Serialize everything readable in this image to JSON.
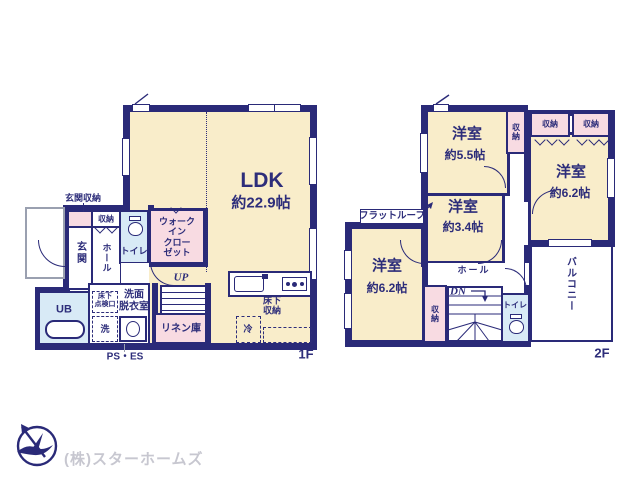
{
  "colors": {
    "wall": "#2a2a78",
    "ink": "#2d2d7a",
    "cream": "#f9edca",
    "pink": "#f8dbe2",
    "blue": "#d8eaf6",
    "logo_text": "#c7c7d0",
    "porch": "#9aa0b0"
  },
  "floor1": {
    "label": "1F",
    "ldk": {
      "name": "LDK",
      "size": "約22.9帖"
    },
    "entrance_storage": "玄関収納",
    "closet": "収納",
    "entrance": "玄関",
    "hall": "ホール",
    "toilet": "トイレ",
    "walk_in_closet": [
      "ウォーク",
      "イン",
      "クロー",
      "ゼット"
    ],
    "unit_bath": "UB",
    "underfloor_hatch": [
      "床下",
      "点検口"
    ],
    "washroom": [
      "洗面",
      "脱衣室"
    ],
    "washer": "洗",
    "linen": "リネン庫",
    "stairs_up": "UP",
    "ps_es": "PS・ES",
    "underfloor_storage": [
      "床下",
      "収納"
    ],
    "fridge": "冷"
  },
  "floor2": {
    "label": "2F",
    "room_5_5": {
      "name": "洋室",
      "size": "約5.5帖"
    },
    "room_6_2_east": {
      "name": "洋室",
      "size": "約6.2帖"
    },
    "room_3_4": {
      "name": "洋室",
      "size": "約3.4帖"
    },
    "room_6_2_west": {
      "name": "洋室",
      "size": "約6.2帖"
    },
    "closet": "収納",
    "flat_roof": "フラットルーフ",
    "hall": "ホール",
    "stairs_down": "DN",
    "toilet": "トイレ",
    "balcony": "バルコニー"
  },
  "footer": {
    "company": "(株)スターホームズ"
  }
}
